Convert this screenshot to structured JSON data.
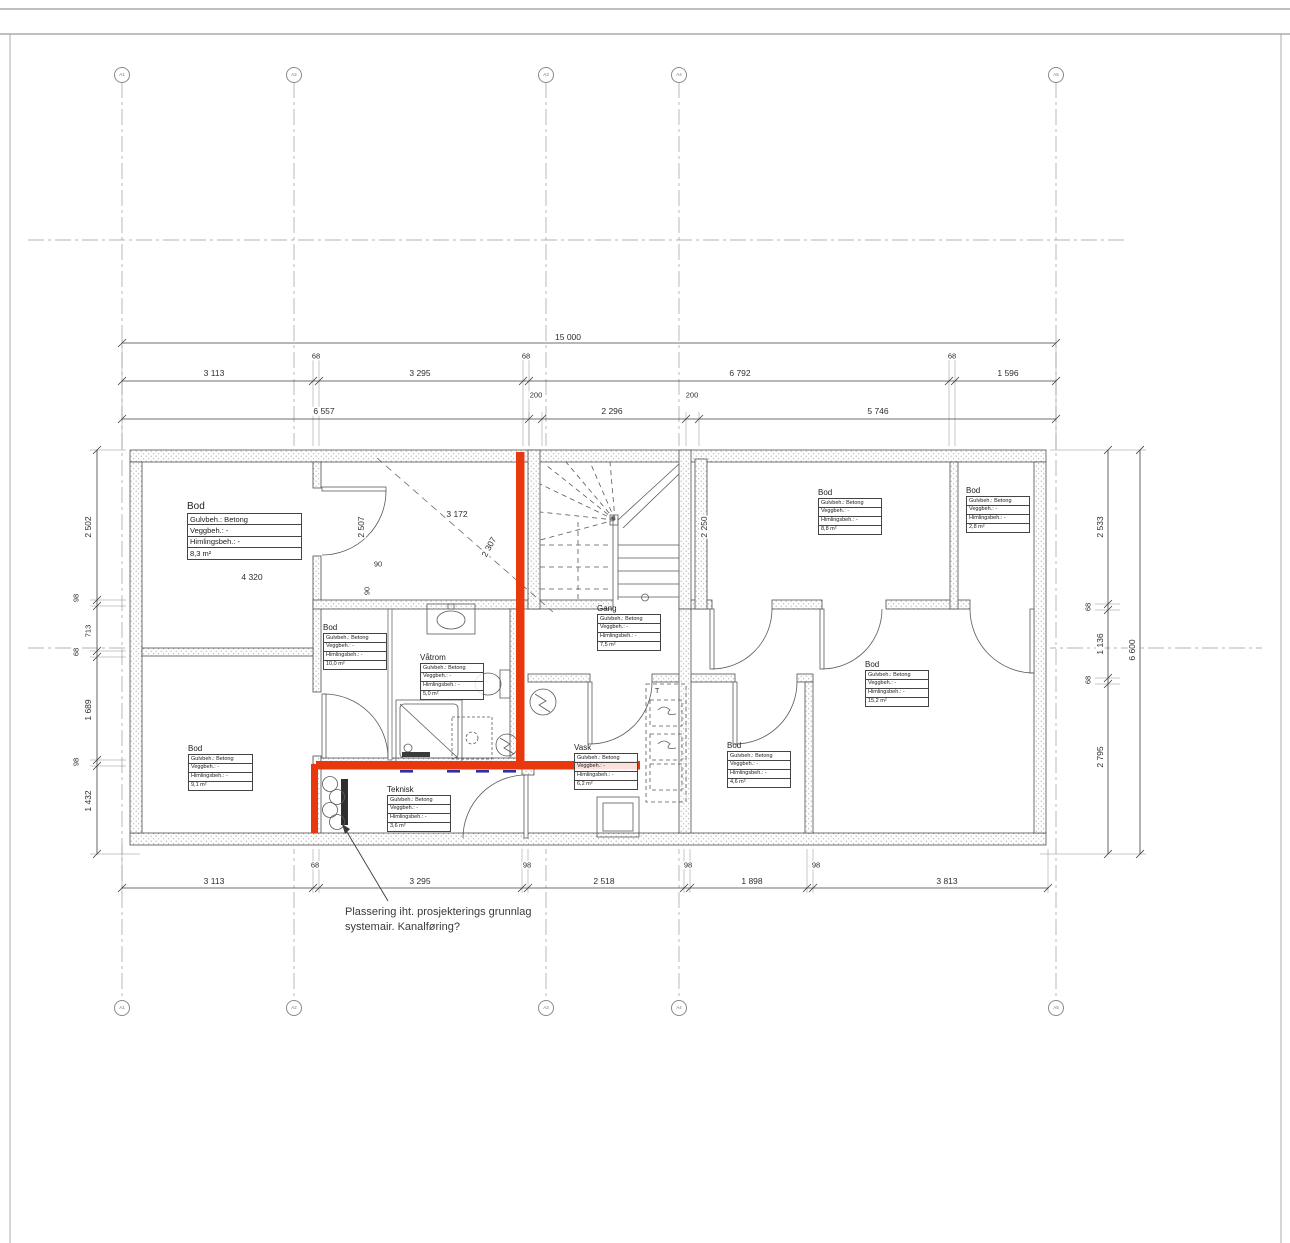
{
  "annotation": {
    "line1": "Plassering iht. prosjekterings grunnlag",
    "line2": "systemair. Kanalføring?"
  },
  "grid_bubbles": {
    "labels": [
      "A1",
      "A2",
      "A3",
      "A4",
      "A5"
    ]
  },
  "rooms": [
    {
      "name": "Bod",
      "area": "8,3 m²",
      "x": 187,
      "y": 513,
      "w": 113,
      "fs": 7.5,
      "nfs": 10,
      "rows": [
        "Gulvbeh.: Betong",
        "Veggbeh.: -",
        "Himlingsbeh.: -"
      ]
    },
    {
      "name": "Bod",
      "area": "10,0 m²",
      "x": 323,
      "y": 633,
      "w": 62,
      "fs": 5.5,
      "nfs": 8,
      "rows": [
        "Gulvbeh.: Betong",
        "Veggbeh.: -",
        "Himlingsbeh.: -"
      ]
    },
    {
      "name": "Våtrom",
      "area": "5,0 m²",
      "x": 420,
      "y": 663,
      "w": 62,
      "fs": 5.5,
      "nfs": 8,
      "rows": [
        "Gulvbeh.: Betong",
        "Veggbeh.: -",
        "Himlingsbeh.: -"
      ]
    },
    {
      "name": "Gang",
      "area": "7,5 m²",
      "x": 597,
      "y": 614,
      "w": 62,
      "fs": 5.5,
      "nfs": 8,
      "rows": [
        "Gulvbeh.: Betong",
        "Veggbeh.: -",
        "Himlingsbeh.: -"
      ]
    },
    {
      "name": "Bod",
      "area": "8,8 m²",
      "x": 818,
      "y": 498,
      "w": 62,
      "fs": 5.5,
      "nfs": 8,
      "rows": [
        "Gulvbeh.: Betong",
        "Veggbeh.: -",
        "Himlingsbeh.: -"
      ]
    },
    {
      "name": "Bod",
      "area": "2,8 m²",
      "x": 966,
      "y": 496,
      "w": 62,
      "fs": 5.5,
      "nfs": 8,
      "rows": [
        "Gulvbeh.: Betong",
        "Veggbeh.: -",
        "Himlingsbeh.: -"
      ]
    },
    {
      "name": "Bod",
      "area": "15,2 m²",
      "x": 865,
      "y": 670,
      "w": 62,
      "fs": 5.5,
      "nfs": 8,
      "rows": [
        "Gulvbeh.: Betong",
        "Veggbeh.: -",
        "Himlingsbeh.: -"
      ]
    },
    {
      "name": "Vask",
      "area": "6,2 m²",
      "x": 574,
      "y": 753,
      "w": 62,
      "fs": 5.5,
      "nfs": 8,
      "rows": [
        "Gulvbeh.: Betong",
        "Veggbeh.: -",
        "Himlingsbeh.: -"
      ]
    },
    {
      "name": "Bod",
      "area": "4,6 m²",
      "x": 727,
      "y": 751,
      "w": 62,
      "fs": 5.5,
      "nfs": 8,
      "rows": [
        "Gulvbeh.: Betong",
        "Veggbeh.: -",
        "Himlingsbeh.: -"
      ]
    },
    {
      "name": "Bod",
      "area": "9,1 m²",
      "x": 188,
      "y": 754,
      "w": 63,
      "fs": 5.5,
      "nfs": 8,
      "rows": [
        "Gulvbeh.: Betong",
        "Veggbeh.: -",
        "Himlingsbeh.: -"
      ]
    },
    {
      "name": "Teknisk",
      "area": "3,6 m²",
      "x": 387,
      "y": 795,
      "w": 62,
      "fs": 5.5,
      "nfs": 8,
      "rows": [
        "Gulvbeh.: Betong",
        "Veggbeh.: -",
        "Himlingsbeh.: -"
      ]
    }
  ],
  "dims": [
    {
      "t": "15 000",
      "x": 568,
      "y": 337
    },
    {
      "t": "3 113",
      "x": 214,
      "y": 373
    },
    {
      "t": "68",
      "x": 316,
      "y": 356
    },
    {
      "t": "3 295",
      "x": 420,
      "y": 373
    },
    {
      "t": "68",
      "x": 526,
      "y": 356
    },
    {
      "t": "6 792",
      "x": 740,
      "y": 373
    },
    {
      "t": "68",
      "x": 952,
      "y": 356
    },
    {
      "t": "1 596",
      "x": 1008,
      "y": 373
    },
    {
      "t": "6 557",
      "x": 324,
      "y": 411
    },
    {
      "t": "200",
      "x": 536,
      "y": 395
    },
    {
      "t": "2 296",
      "x": 612,
      "y": 411
    },
    {
      "t": "200",
      "x": 692,
      "y": 395
    },
    {
      "t": "5 746",
      "x": 878,
      "y": 411
    },
    {
      "t": "3 113",
      "x": 214,
      "y": 881
    },
    {
      "t": "68",
      "x": 315,
      "y": 865
    },
    {
      "t": "3 295",
      "x": 420,
      "y": 881
    },
    {
      "t": "98",
      "x": 527,
      "y": 865
    },
    {
      "t": "2 518",
      "x": 604,
      "y": 881
    },
    {
      "t": "98",
      "x": 688,
      "y": 865
    },
    {
      "t": "1 898",
      "x": 752,
      "y": 881
    },
    {
      "t": "98",
      "x": 816,
      "y": 865
    },
    {
      "t": "3 813",
      "x": 947,
      "y": 881
    },
    {
      "t": "2 502",
      "x": 88,
      "y": 527,
      "r": -90
    },
    {
      "t": "98",
      "x": 76,
      "y": 598,
      "r": -90
    },
    {
      "t": "713",
      "x": 88,
      "y": 631,
      "r": -90
    },
    {
      "t": "68",
      "x": 76,
      "y": 652,
      "r": -90
    },
    {
      "t": "1 689",
      "x": 88,
      "y": 710,
      "r": -90
    },
    {
      "t": "98",
      "x": 76,
      "y": 762,
      "r": -90
    },
    {
      "t": "1 432",
      "x": 88,
      "y": 801,
      "r": -90
    },
    {
      "t": "2 533",
      "x": 1100,
      "y": 527,
      "r": -90
    },
    {
      "t": "68",
      "x": 1088,
      "y": 607,
      "r": -90
    },
    {
      "t": "1 136",
      "x": 1100,
      "y": 644,
      "r": -90
    },
    {
      "t": "68",
      "x": 1088,
      "y": 680,
      "r": -90
    },
    {
      "t": "2 795",
      "x": 1100,
      "y": 757,
      "r": -90
    },
    {
      "t": "6 600",
      "x": 1132,
      "y": 650,
      "r": -90
    },
    {
      "t": "2 507",
      "x": 361,
      "y": 527,
      "r": -90
    },
    {
      "t": "3 172",
      "x": 457,
      "y": 514
    },
    {
      "t": "2 307",
      "x": 489,
      "y": 547,
      "r": -62
    },
    {
      "t": "90",
      "x": 378,
      "y": 564
    },
    {
      "t": "90",
      "x": 367,
      "y": 591,
      "r": -90
    },
    {
      "t": "4 320",
      "x": 252,
      "y": 577
    },
    {
      "t": "2 250",
      "x": 704,
      "y": 527,
      "r": -90
    }
  ],
  "fixture_labels": [
    {
      "t": "T",
      "x": 655,
      "y": 688
    }
  ],
  "colors": {
    "markup_red": "#e8380e",
    "markup_blue": "#31309f"
  }
}
